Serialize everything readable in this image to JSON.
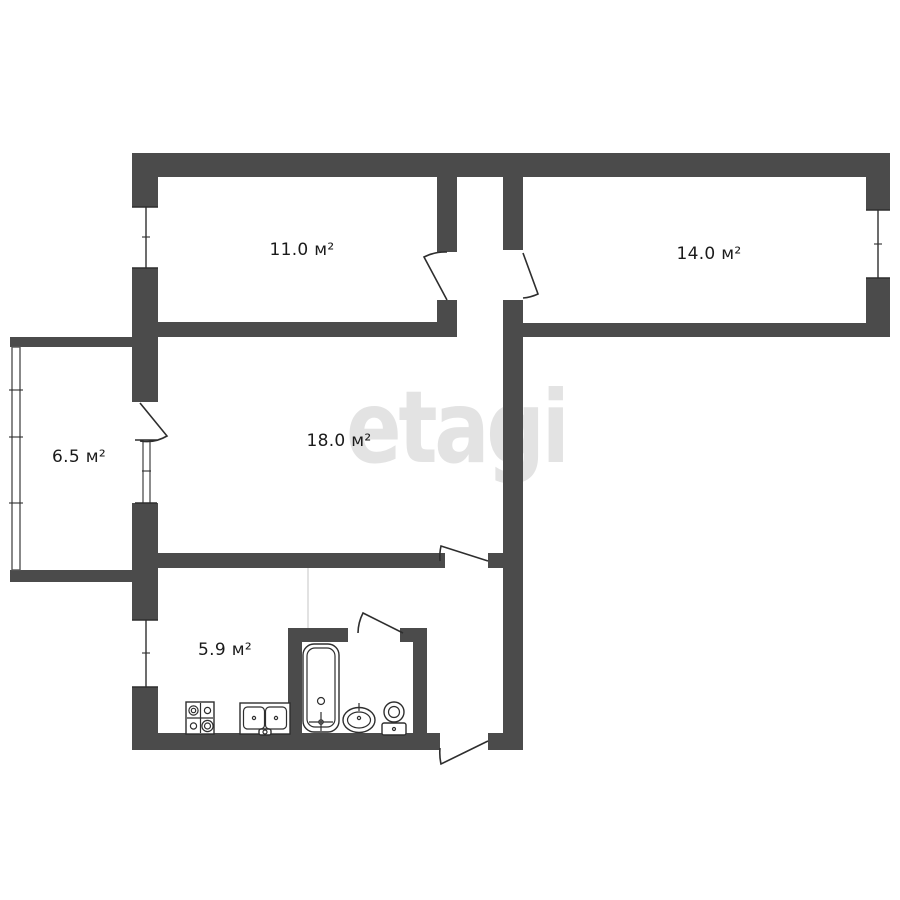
{
  "plan": {
    "title": "apartment-floor-plan",
    "watermark": "etagi",
    "rooms": [
      {
        "name": "bedroom-1",
        "area_label": "11.0 м²"
      },
      {
        "name": "bedroom-2",
        "area_label": "14.0 м²"
      },
      {
        "name": "living-room",
        "area_label": "18.0 м²"
      },
      {
        "name": "balcony",
        "area_label": "6.5 м²"
      },
      {
        "name": "kitchen",
        "area_label": "5.9 м²"
      }
    ],
    "fixtures": [
      "stove",
      "kitchen-sink",
      "bathtub",
      "washbasin",
      "toilet"
    ]
  },
  "colors": {
    "wall": "#4b4b4b",
    "line": "#2e2e2e",
    "watermark": "#e3e3e3",
    "label": "#1b1b1b",
    "bg": "#ffffff",
    "divider": "#d9d9d9",
    "glazing": "#555555"
  }
}
